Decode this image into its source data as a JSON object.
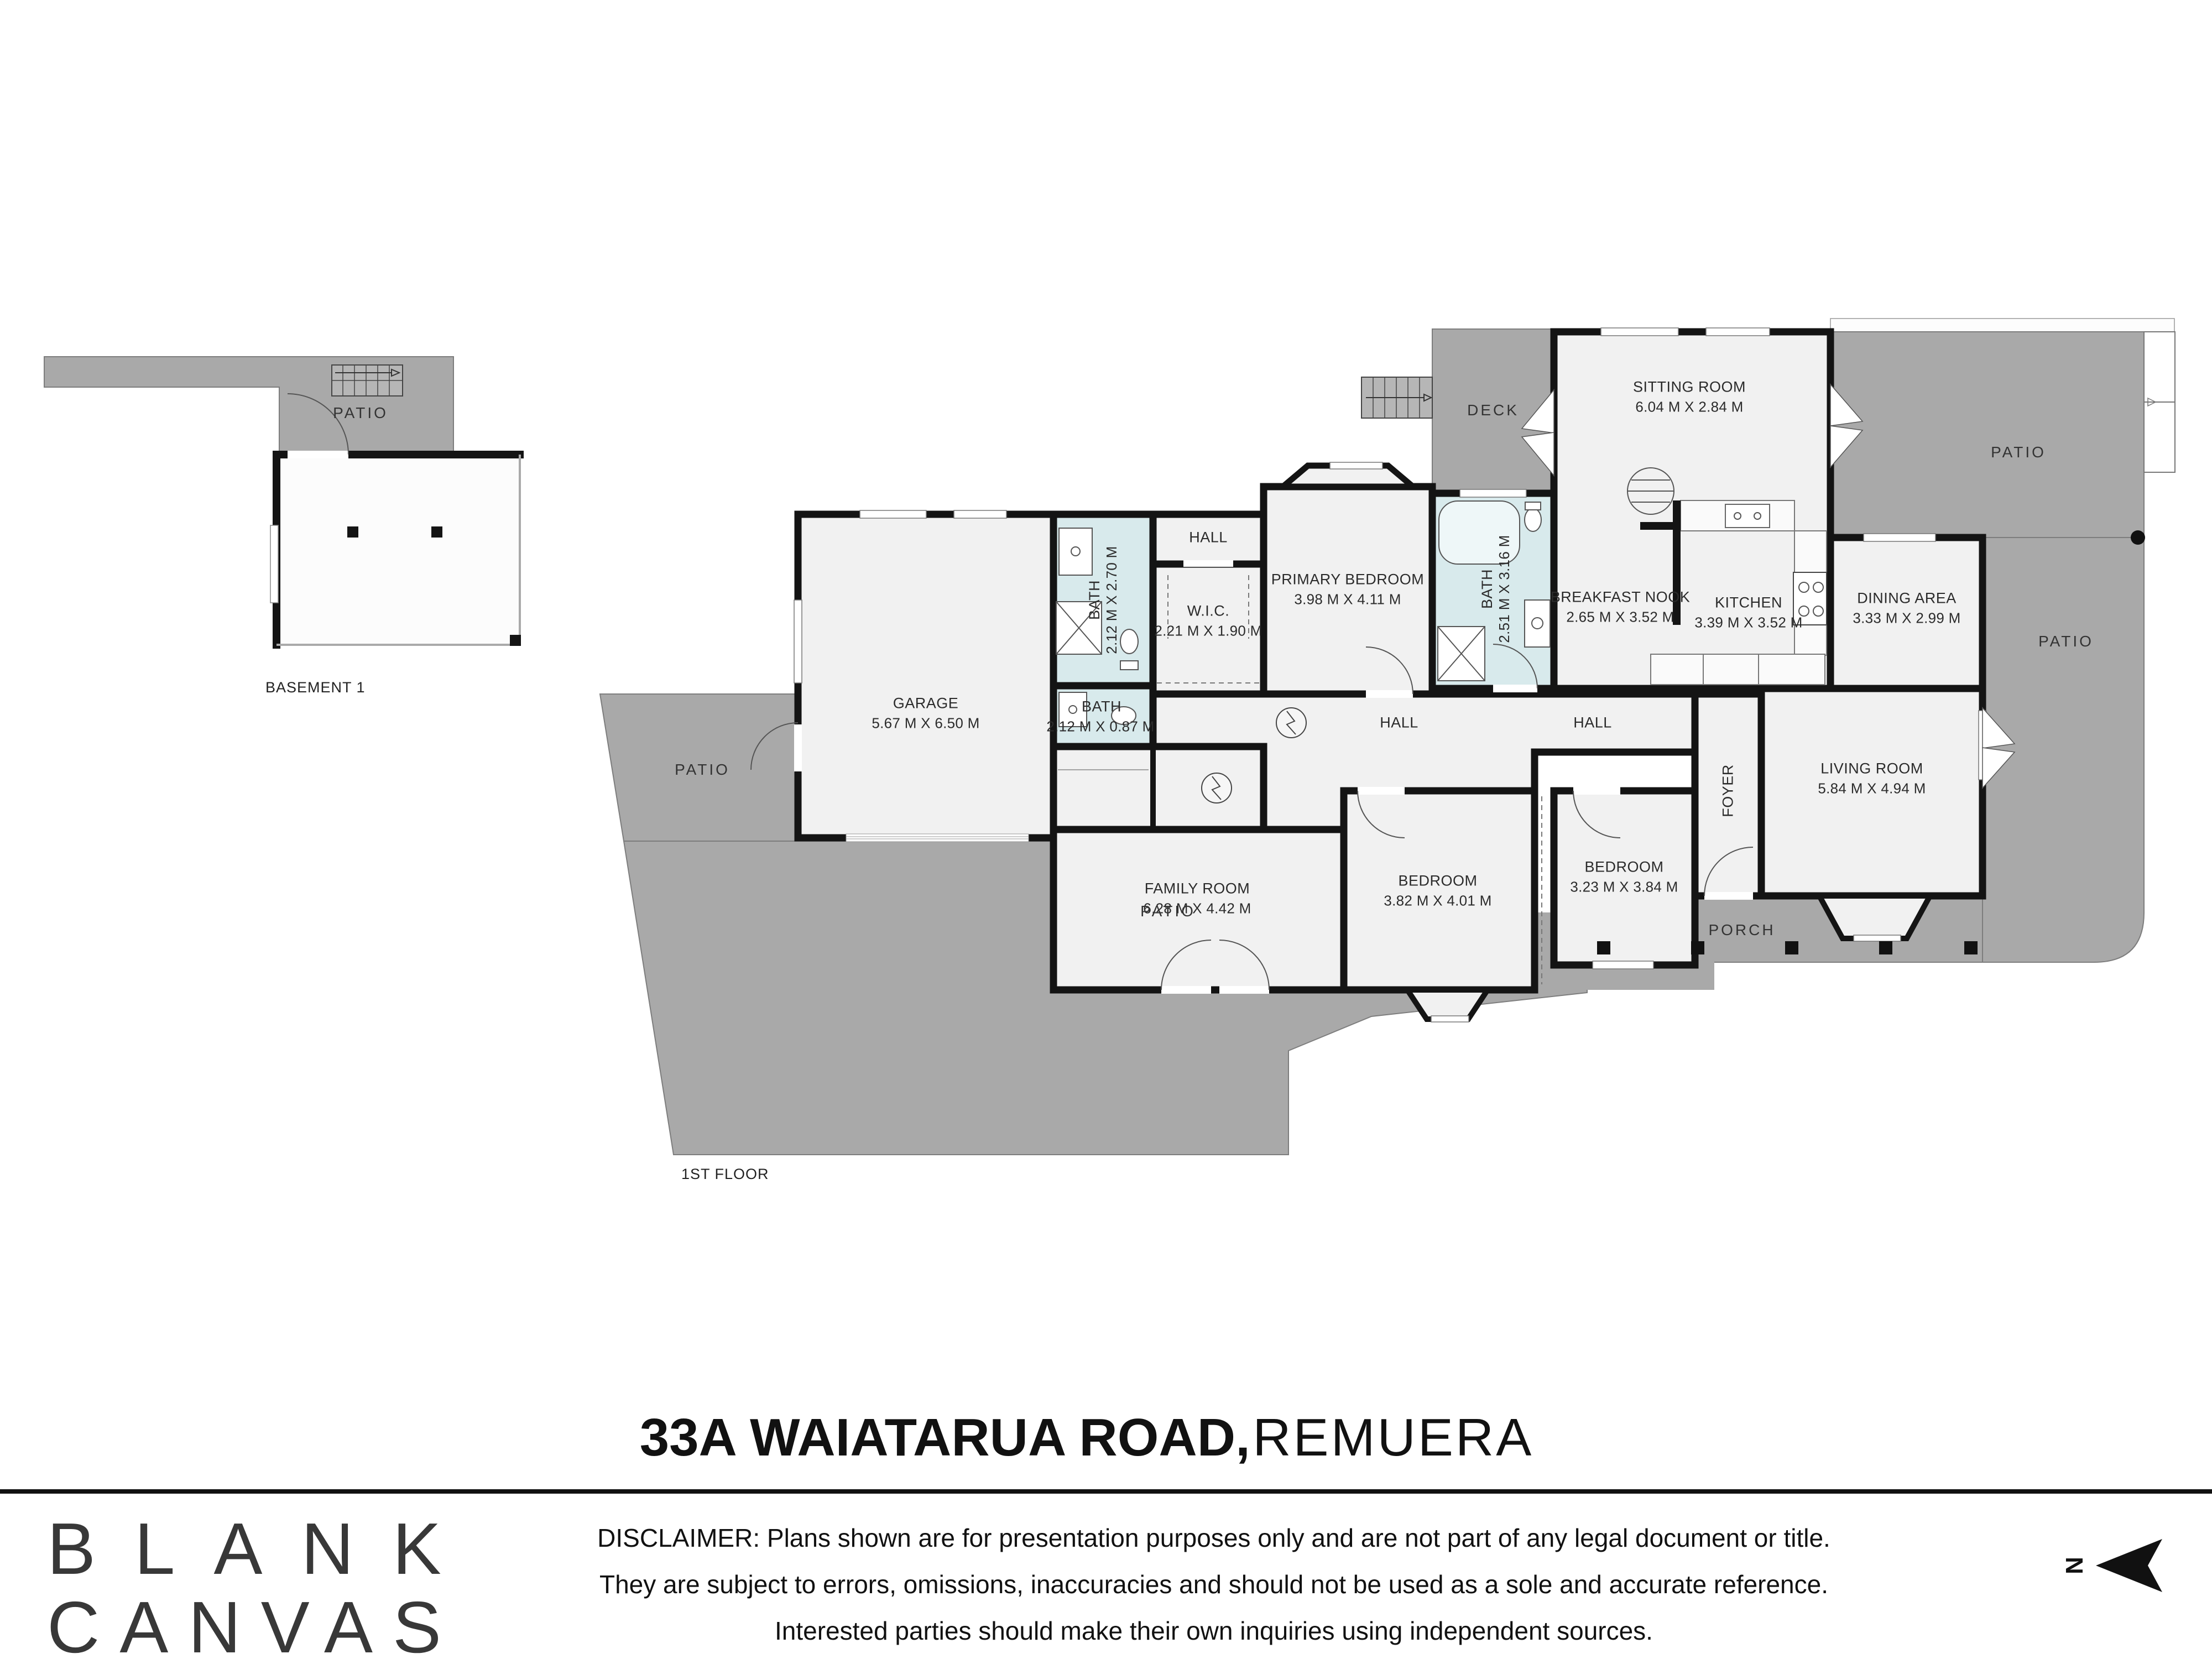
{
  "palette": {
    "wall": "#141414",
    "outdoor_gray": "#a9a9a9",
    "room_fill": "#f1f1f1",
    "bath_fill": "#d8eaec"
  },
  "title": {
    "address": "33A WAIATARUA ROAD,",
    "suburb": "REMUERA"
  },
  "logo": {
    "line1": "BLANK",
    "line2": "CANVAS"
  },
  "disclaimer": {
    "line1": "DISCLAIMER: Plans shown are for presentation purposes only and are not part of any legal document or title.",
    "line2": "They are subject to errors, omissions, inaccuracies and should not be used as a sole and accurate reference.",
    "line3": "Interested parties should make their own inquiries using independent sources."
  },
  "floor_labels": {
    "basement": "BASEMENT 1",
    "first": "1ST FLOOR"
  },
  "outdoor_labels": {
    "patio": "PATIO",
    "deck": "DECK",
    "porch": "PORCH"
  },
  "hall_label": "HALL",
  "compass": {
    "north": "N"
  },
  "rooms": {
    "garage": {
      "name": "GARAGE",
      "dims": "5.67 M X 6.50 M"
    },
    "bath_ensuite": {
      "name": "BATH",
      "dims": "2.12 M X 2.70 M"
    },
    "bath_small": {
      "name": "BATH",
      "dims": "2.12 M X 0.87 M"
    },
    "bath_main": {
      "name": "BATH",
      "dims": "2.51 M X 3.16 M"
    },
    "wic": {
      "name": "W.I.C.",
      "dims": "2.21 M X 1.90 M"
    },
    "primary_bedroom": {
      "name": "PRIMARY BEDROOM",
      "dims": "3.98 M X 4.11 M"
    },
    "sitting_room": {
      "name": "SITTING ROOM",
      "dims": "6.04 M X 2.84 M"
    },
    "breakfast_nook": {
      "name": "BREAKFAST NOOK",
      "dims": "2.65 M X 3.52 M"
    },
    "kitchen": {
      "name": "KITCHEN",
      "dims": "3.39 M X 3.52 M"
    },
    "dining_area": {
      "name": "DINING AREA",
      "dims": "3.33 M X 2.99 M"
    },
    "living_room": {
      "name": "LIVING ROOM",
      "dims": "5.84 M X 4.94 M"
    },
    "family_room": {
      "name": "FAMILY ROOM",
      "dims": "6.28 M X 4.42 M"
    },
    "bedroom_1": {
      "name": "BEDROOM",
      "dims": "3.82 M X 4.01 M"
    },
    "bedroom_2": {
      "name": "BEDROOM",
      "dims": "3.23 M X 3.84 M"
    },
    "foyer": {
      "name": "FOYER"
    }
  }
}
